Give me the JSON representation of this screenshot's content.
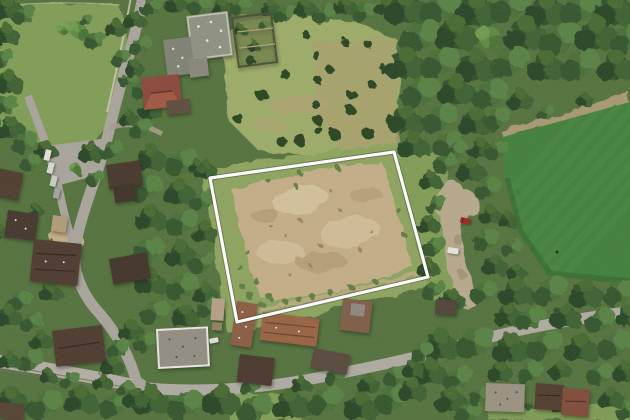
{
  "meta": {
    "image_type": "aerial-orthophoto",
    "subject": "Vacant cleared land parcel outlined in white, set among wooded residential streets; mowed sports field at right, tram street lower-left",
    "visible_text": "none"
  },
  "palette": {
    "canopy_base": "#52703a",
    "lawn": "#7f9c53",
    "meadow": "#9cab66",
    "scrub": "#a7a06b",
    "parcel_grass": "#8ca35b",
    "dirt": "#c3ad85",
    "dirt_light": "#d8c7a2",
    "dirt_dark": "#a8906a",
    "field": "#3f7e39",
    "field_stripe": "#4b8c41",
    "field_shadow": "#2c5c2a",
    "field_dirt_strip": "#a6986f",
    "road": "#a8a49b",
    "tram_road": "#b2ada4",
    "bottom_road": "#aeaaa0",
    "dirt_road": "#b6a88b",
    "wall": "#d2c9b8",
    "roof_flat": "#8d9080",
    "roof_red": "#8a4638",
    "roof_rust": "#97613f",
    "roof_brown": "#4b382b",
    "roof_dark": "#3f3227",
    "tan_shed": "#b09a77",
    "car_red": "#a1241b",
    "car_white": "#e6e4de"
  },
  "parcel": {
    "outline_color": "#ffffff",
    "outline_shadow": "rgba(0,0,0,0.35)",
    "stroke_width": 3.2,
    "corners": "210,178 394,152 428,277 237,322",
    "surface": "cleared bare earth with grass margin and scrub at lower-left"
  },
  "features": {
    "sports_field": "bright mowed pitch with diagonal mowing stripes, right edge",
    "tram_street": "double tram tracks on lower-left road",
    "dirt_access_road": "tan track between parcel and sports field",
    "red_car": "parked beside dirt access road",
    "parked_cars": "row of 4 vehicles along upper-left street",
    "buildings": "flat-roofed complex upper-left, red hipped roof house, dark brown roofed houses west, rust-red roofed houses south of parcel"
  }
}
